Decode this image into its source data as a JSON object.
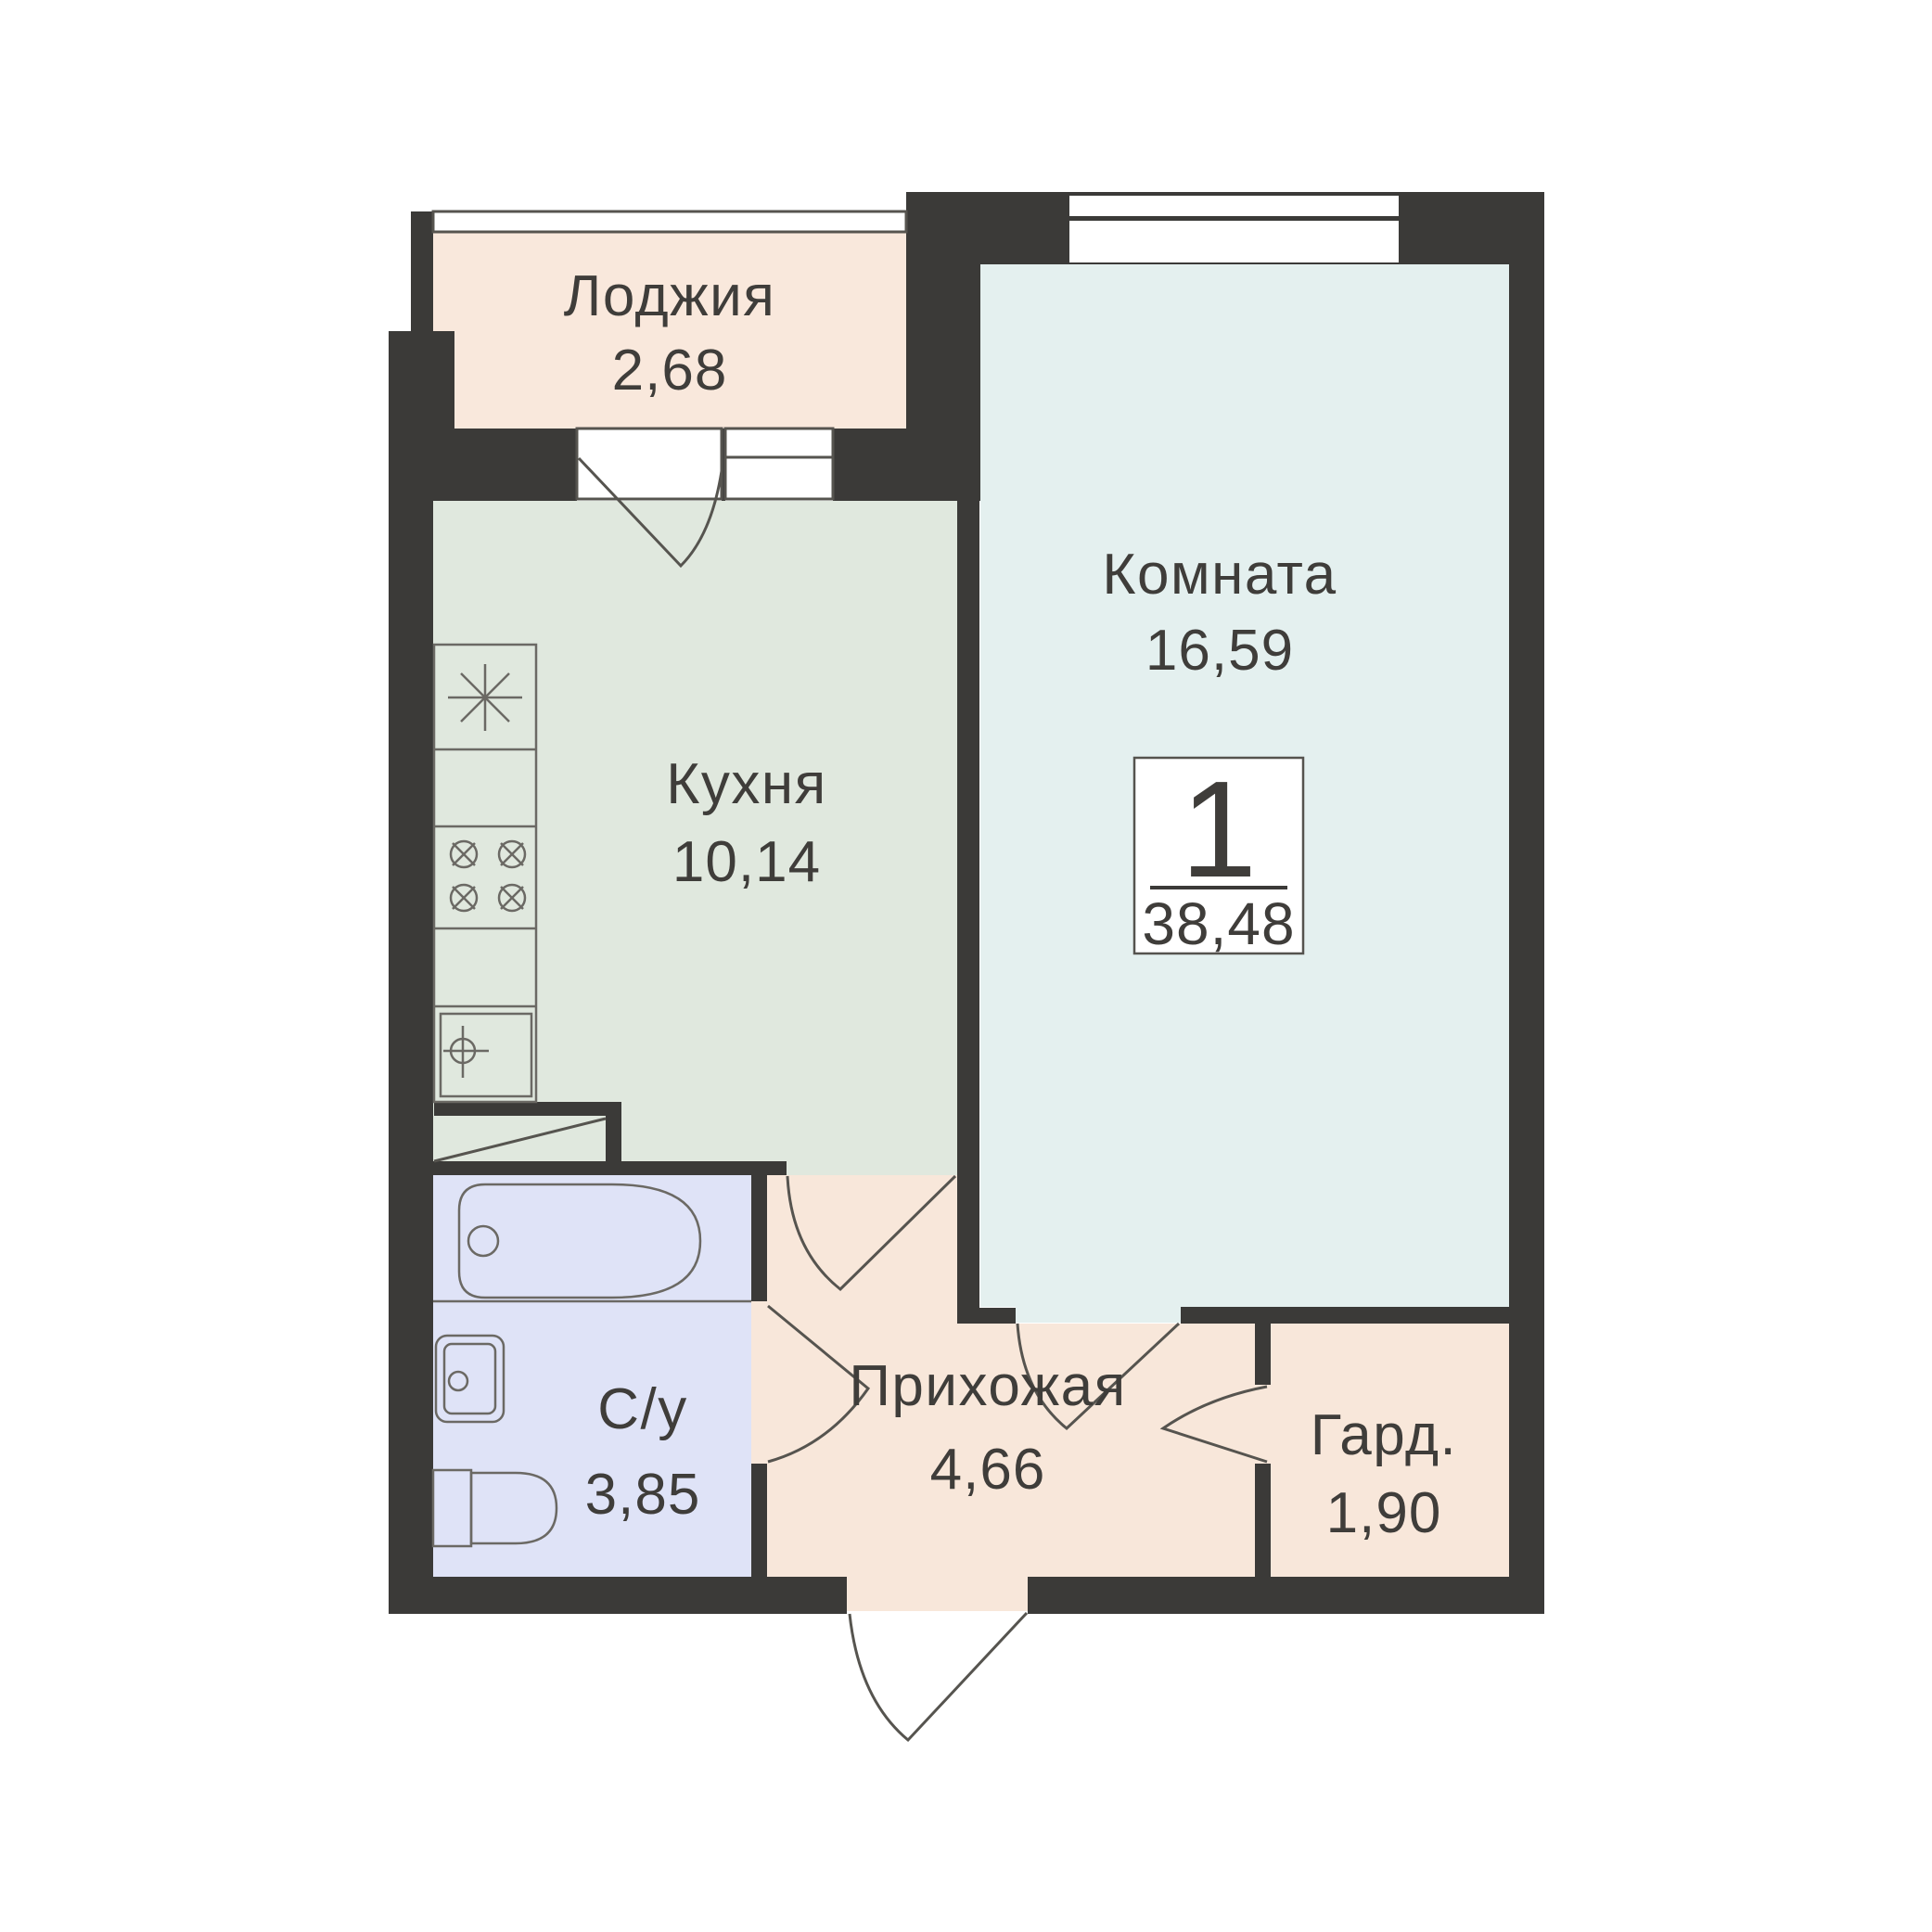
{
  "badge": {
    "rooms_count": "1",
    "total_area": "38,48"
  },
  "rooms": {
    "loggia": {
      "label": "Лоджия",
      "area": "2,68"
    },
    "living": {
      "label": "Комната",
      "area": "16,59"
    },
    "kitchen": {
      "label": "Кухня",
      "area": "10,14"
    },
    "bathroom": {
      "label": "С/у",
      "area": "3,85"
    },
    "hallway": {
      "label": "Прихожая",
      "area": "4,66"
    },
    "wardrobe": {
      "label": "Гард.",
      "area": "1,90"
    }
  },
  "colors": {
    "wall": "#3b3a38",
    "line": "#56544f",
    "ink": "#3f3d3a",
    "bg": "#ffffff",
    "loggia": "#f9e8dc",
    "kitchen": "#e0e8de",
    "living": "#e4f0ef",
    "bath": "#dfe3f7",
    "hall": "#f8e7da",
    "wardrobe": "#f8e7da",
    "fixture": "#6b6964"
  }
}
